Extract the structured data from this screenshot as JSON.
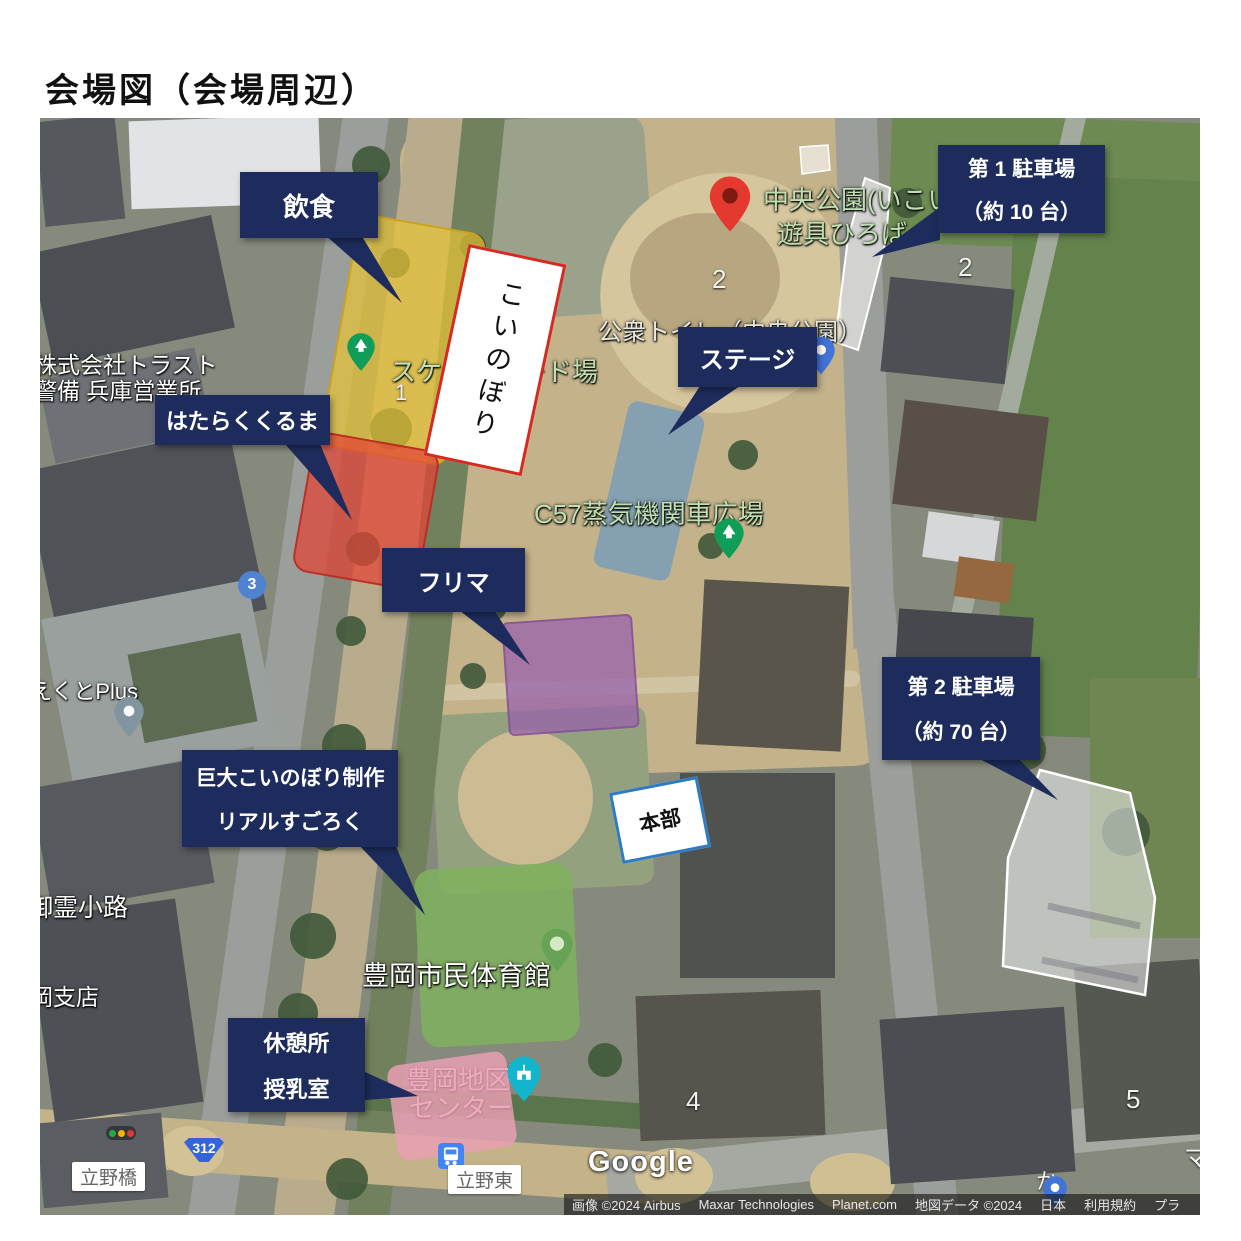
{
  "page": {
    "title": "会場図（会場周辺）"
  },
  "callouts": {
    "inshoku": {
      "label": "飲食"
    },
    "hatarakukuruma": {
      "label": "はたらくくるま"
    },
    "stage": {
      "label": "ステージ"
    },
    "furima": {
      "label": "フリマ"
    },
    "parking1": {
      "line1": "第 1 駐車場",
      "line2": "（約 10 台）"
    },
    "parking2": {
      "line1": "第 2 駐車場",
      "line2": "（約 70 台）"
    },
    "kyodai": {
      "line1": "巨大こいのぼり制作",
      "line2": "リアルすごろく"
    },
    "kyukeijo": {
      "line1": "休憩所",
      "line2": "授乳室"
    }
  },
  "area_boxes": {
    "koinobori": "こいのぼり",
    "honbu": "本部"
  },
  "map_labels": {
    "chuo_koen": "中央公園(いこい",
    "yugu_hiroba": "遊具ひろば",
    "koshu_toilet": "公衆トイレ（中央公園）",
    "skateboard": "スケートボード場",
    "c57": "C57蒸気機関車広場",
    "trust_line1": "株式会社トラスト",
    "trust_line2": "警備 兵庫営業所",
    "kuto_plus": "えくとPlus",
    "goryo_koji": "御霊小路",
    "oka_shiten": "岡支店",
    "taiikukan": "豊岡市民体育館",
    "chiku": "豊岡地区",
    "center": "センター",
    "tachino_bashi": "立野橋",
    "tachino_higashi": "立野東",
    "num_1": "1",
    "num_2a": "2",
    "num_2b": "2",
    "num_3": "3",
    "num_4": "4",
    "num_5": "5",
    "char_ma": "マ",
    "char_ka": "か",
    "route_312": "312"
  },
  "watermark": {
    "google": "Google"
  },
  "attribution": {
    "items": [
      "画像 ©2024 Airbus",
      "Maxar Technologies",
      "Planet.com",
      "地図データ ©2024",
      "日本",
      "利用規約",
      "プラ"
    ]
  },
  "colors": {
    "callout_navy": "#1d2c5c",
    "zone_yellow": "#e9c534",
    "zone_red": "#e34334",
    "zone_blue": "#789eb9",
    "zone_purple": "#9861ac",
    "zone_green": "#7fb25d",
    "zone_pink": "#eca0b4",
    "zone_parking_white": "#ffffff",
    "koinobori_border_red": "#d42a20",
    "honbu_border_blue": "#2d7cc1",
    "park_label_green": "#bfe0b0",
    "red_pin": "#e3392e",
    "tree_pin_green": "#0f9d58",
    "teal_building_pin": "#12b5cb",
    "bus_icon_blue": "#4285f4",
    "route_shield_blue": "#3464d8"
  }
}
